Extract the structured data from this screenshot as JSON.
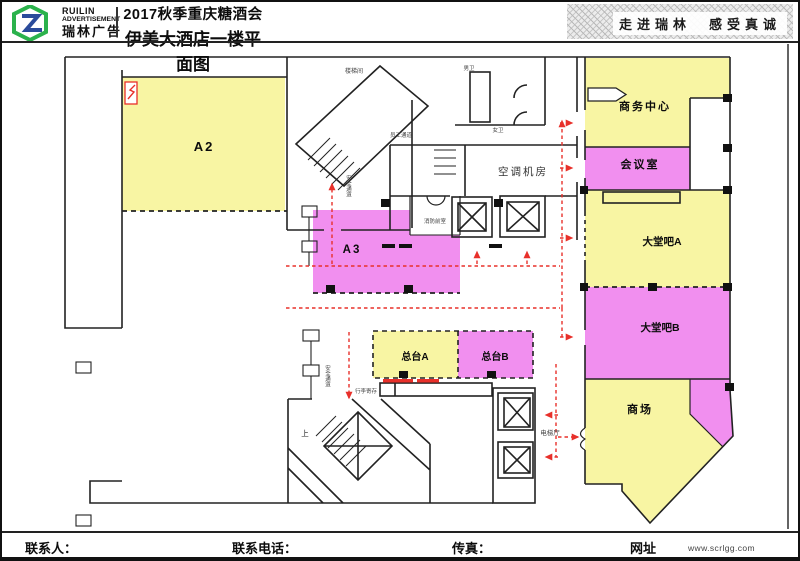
{
  "header": {
    "logo": {
      "brand_line1": "RUILIN",
      "brand_line2": "ADVERTISEMENT",
      "brand_cn": "瑞林广告"
    },
    "title_line1": "2017秋季重庆糖酒会",
    "title_line2": "伊美大酒店一楼平面图",
    "slogan": "走进瑞林　感受真诚"
  },
  "footer": {
    "contact_label": "联系人：",
    "phone_label": "联系电话：",
    "fax_label": "传真：",
    "web_label": "网址",
    "url": "www.scrlgg.com"
  },
  "colors": {
    "region_yellow": "#F8F5A3",
    "region_magenta": "#F18FEF",
    "route_red": "#E8302A",
    "wall": "#222222",
    "logo_green": "#2BB24C",
    "logo_blue": "#2B4B9B"
  },
  "plan": {
    "regions": {
      "a2": "A2",
      "a3": "A3",
      "frontdesk_a": "总台A",
      "frontdesk_b": "总台B",
      "business_center": "商务中心",
      "meeting_room": "会议室",
      "lobby_bar_a": "大堂吧A",
      "lobby_bar_b": "大堂吧B",
      "mall": "商场"
    },
    "rooms": {
      "stairwell": "楼梯间",
      "staff_passage": "员工通道",
      "mens_wc": "男卫",
      "womens_wc": "女卫",
      "ac_machine_room": "空调机房",
      "fire_anteroom": "消防前室",
      "elevator_hall": "电梯厅",
      "luggage_storage": "行李寄存",
      "stairs_up": "上",
      "safe_passage_1": "安全通道",
      "safe_passage_2": "安全通道"
    }
  }
}
